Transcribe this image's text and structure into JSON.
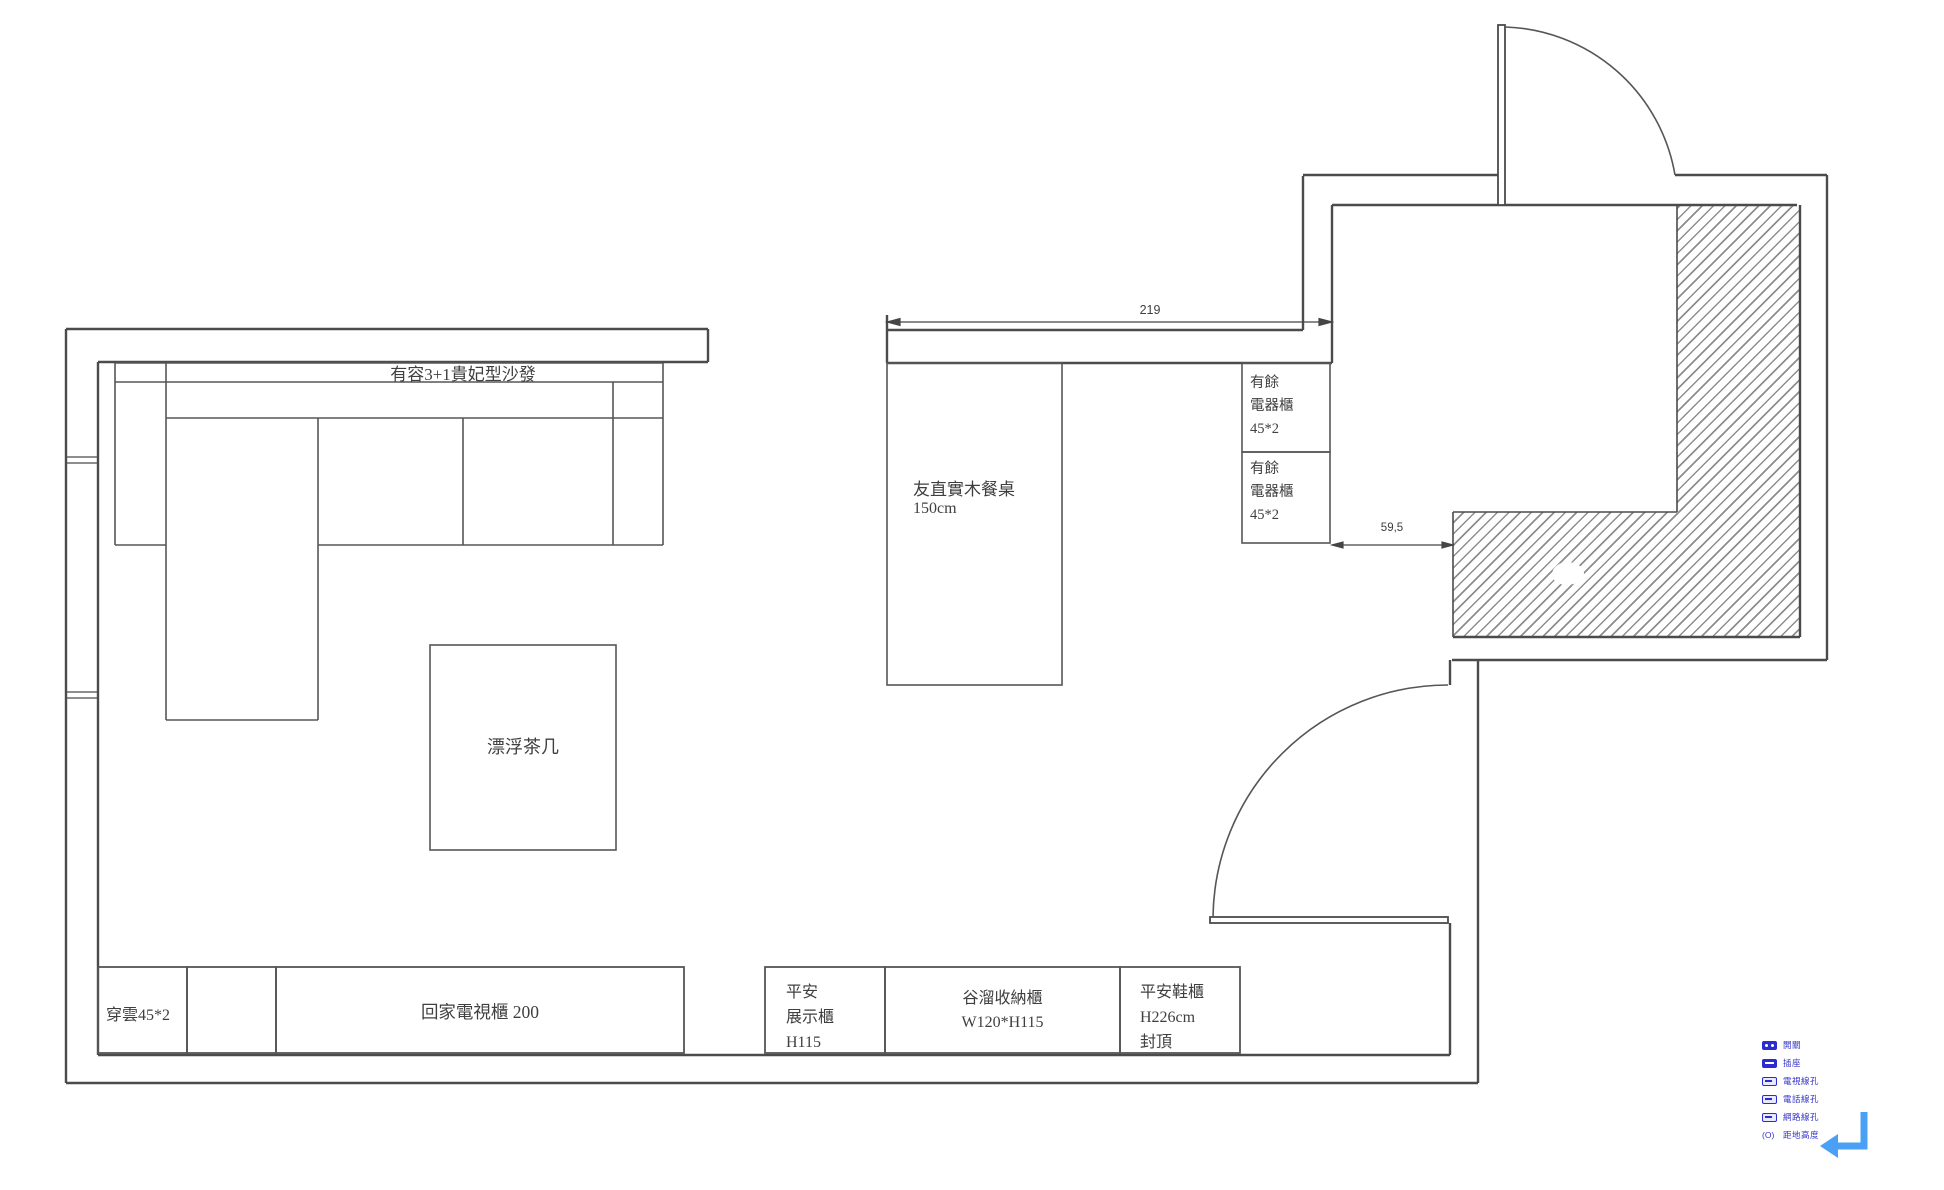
{
  "title": "living-dining floor plan",
  "furniture": {
    "sofa": "有容3+1貴妃型沙發",
    "coffee_table": "漂浮茶几",
    "dining_table": [
      "友直實木餐桌",
      "150cm"
    ],
    "appliance_cabinet_1": [
      "有餘",
      "電器櫃",
      "45*2"
    ],
    "appliance_cabinet_2": [
      "有餘",
      "電器櫃",
      "45*2"
    ],
    "chuanyun_cabinet": "穿雲45*2",
    "tv_cabinet": "回家電視櫃 200",
    "display_cabinet": [
      "平安",
      "展示櫃",
      "H115"
    ],
    "storage_cabinet": [
      "谷溜收納櫃",
      "W120*H115"
    ],
    "shoe_cabinet": [
      "平安鞋櫃",
      "H226cm",
      "封頂"
    ]
  },
  "dimensions": {
    "top_width": "219",
    "passage_width": "59,5"
  },
  "legend": {
    "items": [
      {
        "icon": "switch-icon",
        "label": "開關"
      },
      {
        "icon": "outlet-icon",
        "label": "插座"
      },
      {
        "icon": "tv-line-icon",
        "label": "電視線孔"
      },
      {
        "icon": "phone-line-icon",
        "label": "電話線孔"
      },
      {
        "icon": "network-line-icon",
        "label": "網路線孔"
      },
      {
        "icon": "floor-height-icon",
        "prefix": "(O)",
        "label": "距地高度"
      }
    ]
  },
  "colors": {
    "wall_line": "#4b4b4b",
    "furniture_line": "#565656",
    "dimension_line": "#454545",
    "hatch_gray": "#8e8e8e",
    "legend_blue": "#2b2bd0",
    "arrow_blue": "#4aa0f5"
  }
}
